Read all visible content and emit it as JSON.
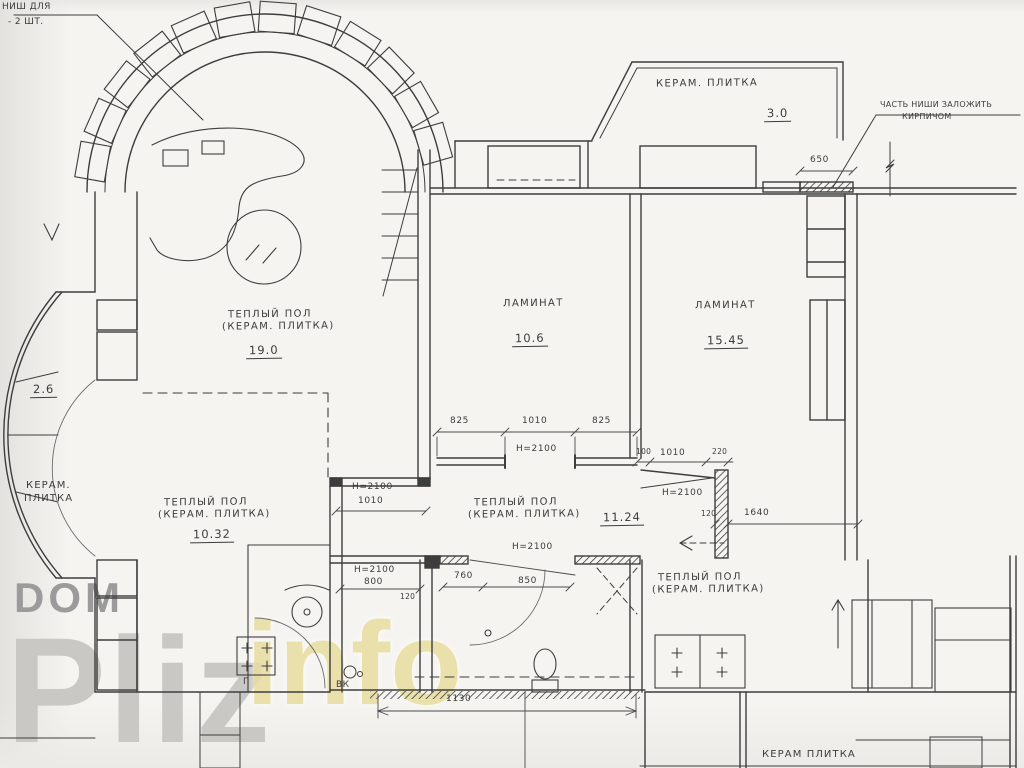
{
  "document": {
    "kind": "scanned apartment floor plan (flooring / heights markup)",
    "language": "ru"
  },
  "colors": {
    "ink": "#3d3d3d",
    "paper": "#f5f4f1",
    "watermark_gray_dark": "#9b9b9b",
    "watermark_gray_light": "#c9c8c5",
    "watermark_yellow": "#e9dd9f"
  },
  "notes": {
    "niche_line1": "НИШ ДЛЯ",
    "niche_line2": "- 2 ШТ.",
    "brick_line1": "ЧАСТЬ НИШИ ЗАЛОЖИТЬ",
    "brick_line2": "КИРПИЧОМ",
    "vk": "ВК",
    "g_mark": "Г"
  },
  "rooms": {
    "balcony_top": {
      "finish": "КЕРАМ. ПЛИТКА",
      "area": "3.0"
    },
    "living_arch": {
      "finish1": "ТЕПЛЫЙ ПОЛ",
      "finish2": "(КЕРАМ. ПЛИТКА)",
      "area": "19.0"
    },
    "bedroom_mid": {
      "finish": "ЛАМИНАТ",
      "area": "10.6"
    },
    "bedroom_right": {
      "finish": "ЛАМИНАТ",
      "area": "15.45"
    },
    "bay_left": {
      "finish1": "КЕРАМ.",
      "finish2": "ПЛИТКА",
      "area": "2.6"
    },
    "room_lower_left": {
      "finish1": "ТЕПЛЫЙ ПОЛ",
      "finish2": "(КЕРАМ. ПЛИТКА)",
      "area": "10.32"
    },
    "hall": {
      "finish1": "ТЕПЛЫЙ ПОЛ",
      "finish2": "(КЕРАМ. ПЛИТКА)",
      "area": "11.24"
    },
    "kitchen": {
      "finish1": "ТЕПЛЫЙ ПОЛ",
      "finish2": "(КЕРАМ. ПЛИТКА)"
    },
    "balcony_bottom": {
      "finish": "КЕРАМ ПЛИТКА"
    }
  },
  "dimensions": {
    "d650": "650",
    "d825a": "825",
    "d1010a": "1010",
    "d825b": "825",
    "h2100_mid_door": "Н=2100",
    "d100": "100",
    "d1010b": "1010",
    "d220": "220",
    "h2100_right_door": "Н=2100",
    "d120a": "120",
    "d1640": "1640",
    "h2100_left_door": "Н=2100",
    "d1010c": "1010",
    "h2100_bath_door": "Н=2100",
    "d760": "760",
    "d850": "850",
    "h2100_wc_door": "Н=2100",
    "d800": "800",
    "d120b": "120",
    "d1130": "1130"
  },
  "watermark": {
    "line1": "DOM",
    "line2": "Pliz",
    "line3": "info"
  }
}
